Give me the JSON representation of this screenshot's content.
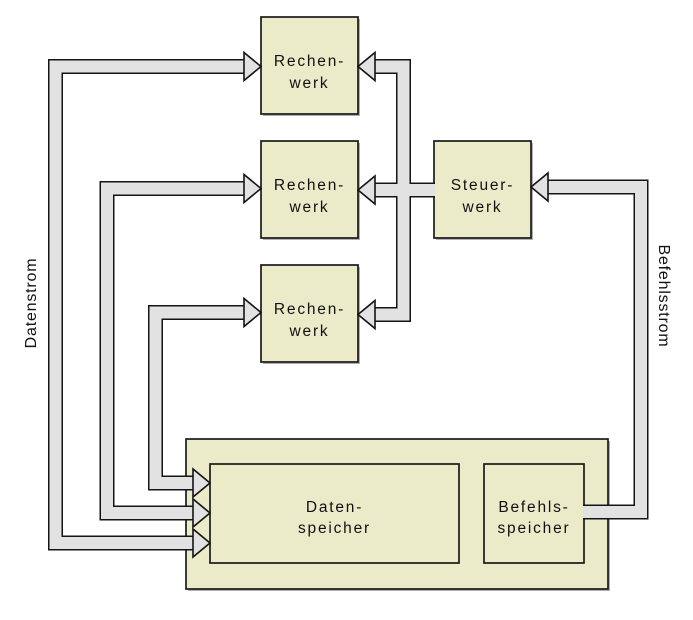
{
  "diagram": {
    "title": "MISD/Multiprocessor block diagram (German)",
    "nodes": {
      "rw1": {
        "line1": "Rechen-",
        "line2": "werk"
      },
      "rw2": {
        "line1": "Rechen-",
        "line2": "werk"
      },
      "rw3": {
        "line1": "Rechen-",
        "line2": "werk"
      },
      "sw": {
        "line1": "Steuer-",
        "line2": "werk"
      },
      "ds": {
        "line1": "Daten-",
        "line2": "speicher"
      },
      "bs": {
        "line1": "Befehls-",
        "line2": "speicher"
      }
    },
    "stream_labels": {
      "left": "Datenstrom",
      "right": "Befehlsstrom"
    },
    "colors": {
      "box_fill": "#ebebc9",
      "box_border": "#1a1a1a",
      "box_shadow": "#b0b0b0",
      "channel_fill": "#e2e2e2",
      "channel_border": "#141414",
      "background": "#ffffff",
      "text": "#111111"
    }
  }
}
